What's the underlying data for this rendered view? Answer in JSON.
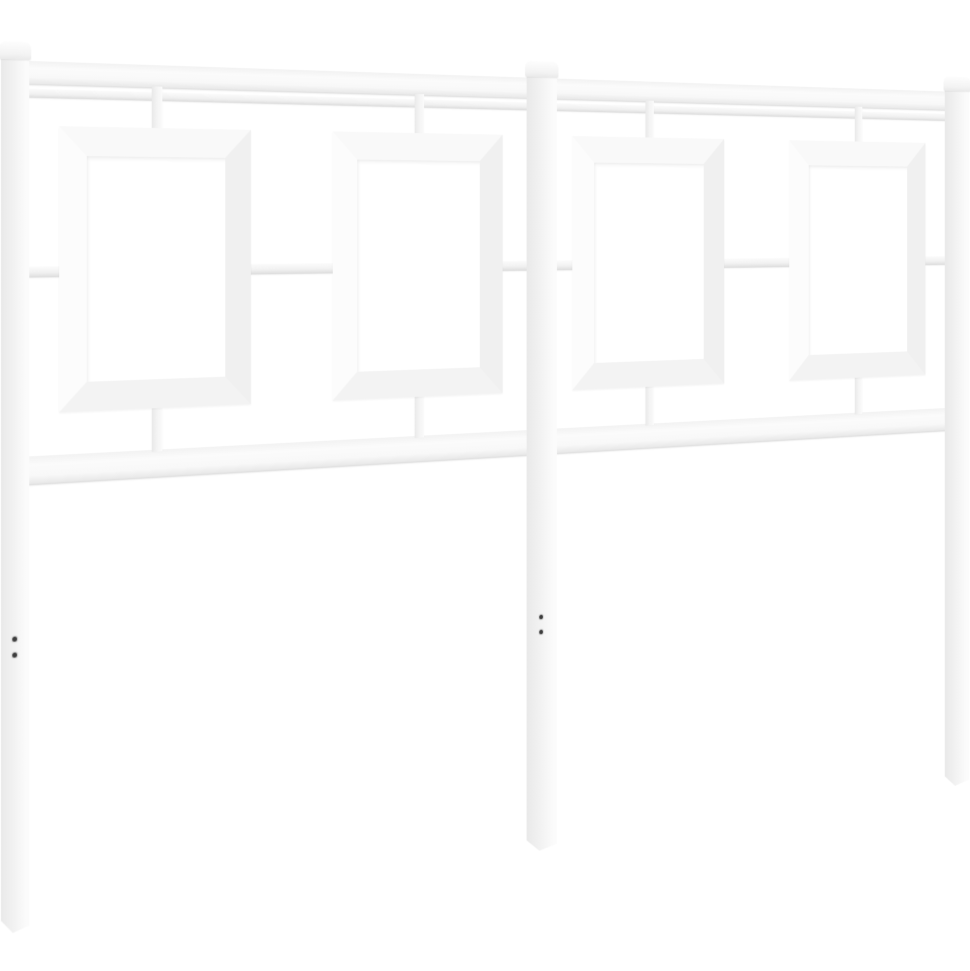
{
  "scene": {
    "description": "Product photograph of a white metal bed headboard on a plain white background, viewed at a slight angle receding to the right",
    "object": "white metal headboard",
    "post_count": 3,
    "decorative_panel_count": 4,
    "horizontal_rail_count": 4,
    "mounting_holes_visible": 4,
    "background_style": "plain seamless white"
  },
  "colors": {
    "bg": "#ffffff",
    "metal": "#fbfbfb",
    "metal_mid": "#f3f3f3",
    "shade": "#e9e9e9",
    "deep": "#dcdcdc",
    "dot": "#3c3c3c"
  }
}
